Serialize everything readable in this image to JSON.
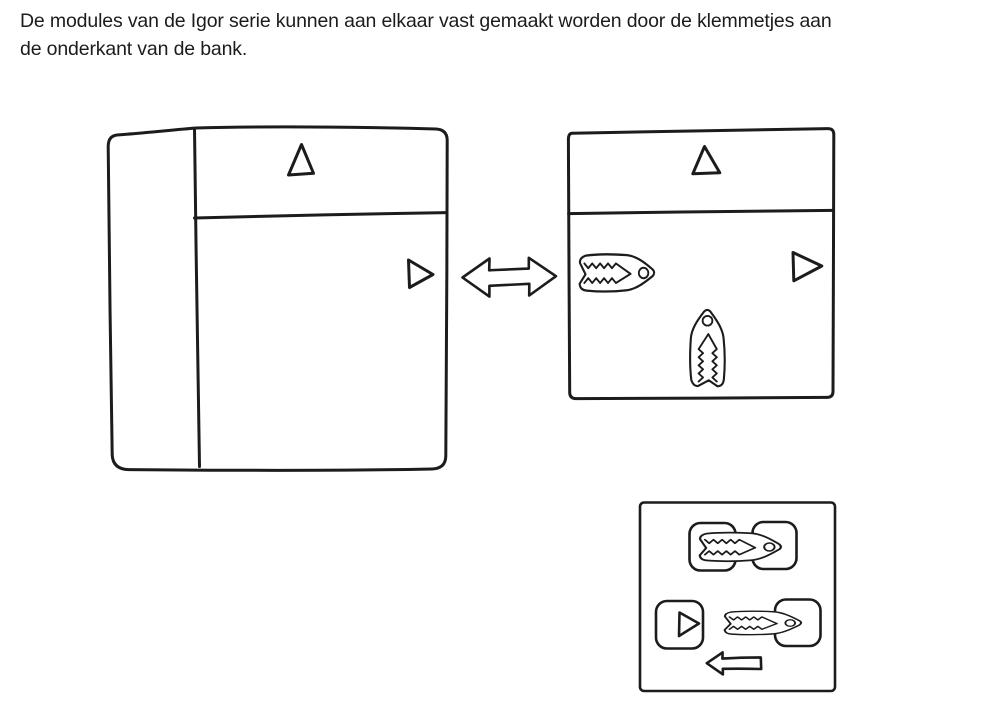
{
  "colors": {
    "background": "#ffffff",
    "ink": "#1c1c1c"
  },
  "caption": {
    "lines": [
      "De modules van de Igor serie kunnen aan elkaar vast gemaakt worden door de klemmetjes aan",
      "de onderkant van de bank."
    ]
  },
  "icons": {
    "triangle_up": "front-direction-marker",
    "triangle_right": "side-direction-marker",
    "double_arrow": "attach-both-ways-arrow",
    "clip": "klemmetje-clip",
    "arrow_left": "slide-clip-direction-arrow"
  }
}
